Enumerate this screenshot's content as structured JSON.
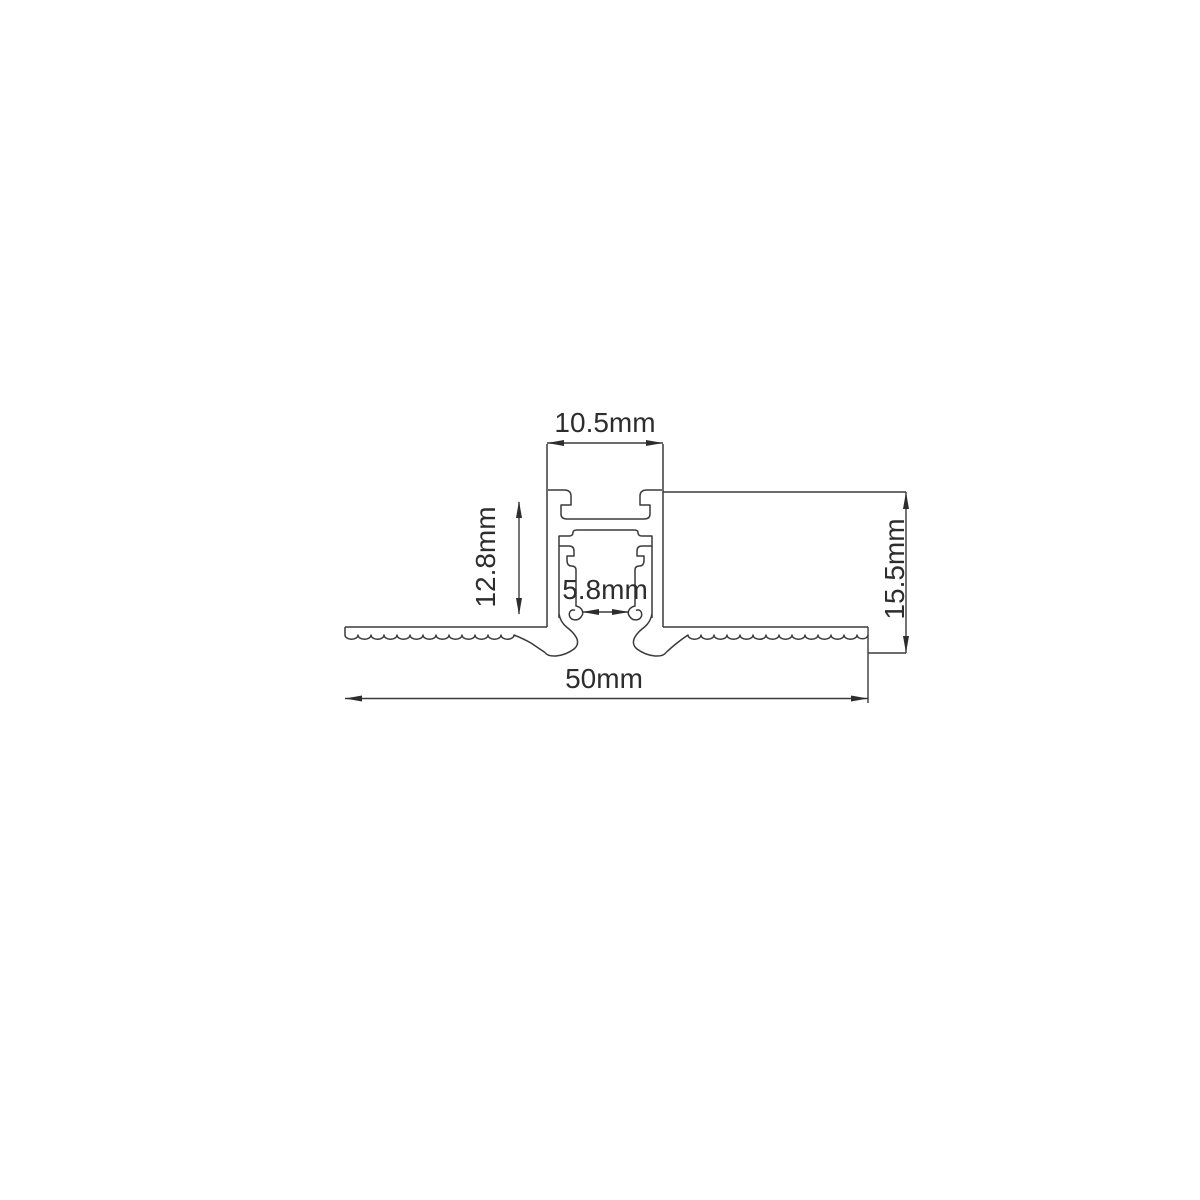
{
  "drawing": {
    "kind": "technical-cross-section",
    "subject": "recessed-profile-cross-section",
    "background_color": "#ffffff",
    "line_color": "#3a3a3a",
    "text_color": "#2d2d2d",
    "dimensions": {
      "top_width": {
        "label": "10.5mm",
        "orientation": "horizontal"
      },
      "recess_depth": {
        "label": "12.8mm",
        "orientation": "vertical"
      },
      "slot_width": {
        "label": "5.8mm",
        "orientation": "horizontal"
      },
      "overall_depth": {
        "label": "15.5mm",
        "orientation": "vertical"
      },
      "overall_width": {
        "label": "50mm",
        "orientation": "horizontal"
      }
    }
  }
}
